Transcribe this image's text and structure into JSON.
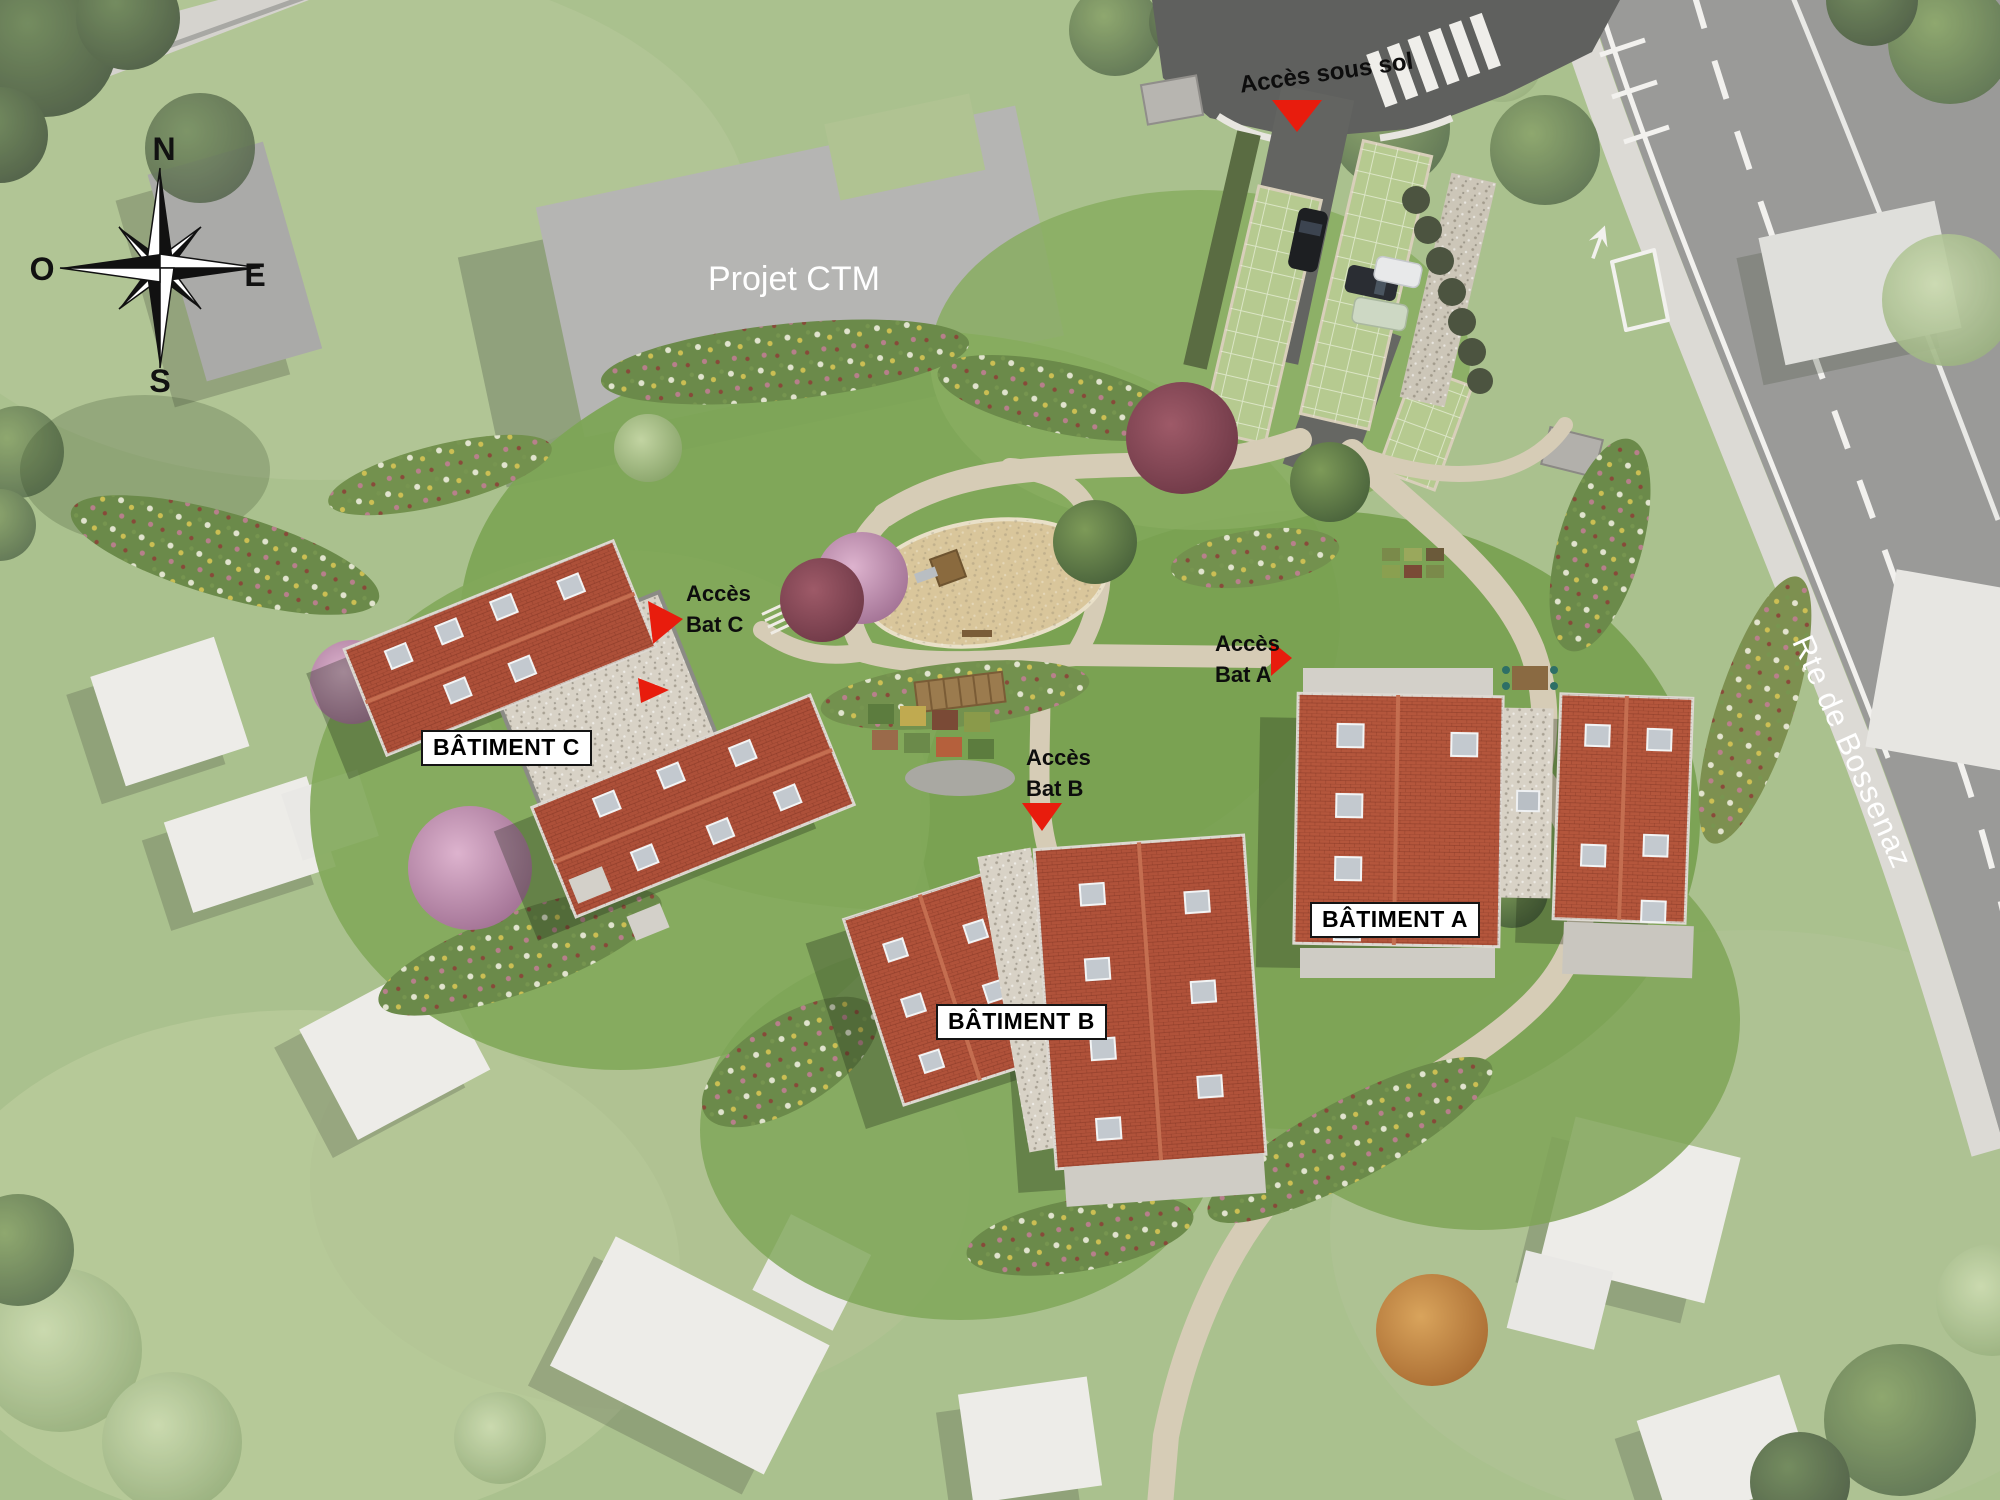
{
  "compass": {
    "n": "N",
    "o": "O",
    "e": "E",
    "s": "S"
  },
  "context": {
    "projet_ctm": "Projet CTM",
    "road_name": "Rte de Bossenaz"
  },
  "buildings": {
    "a": {
      "label": "BÂTIMENT A"
    },
    "b": {
      "label": "BÂTIMENT B"
    },
    "c": {
      "label": "BÂTIMENT C"
    }
  },
  "access": {
    "sous_sol": {
      "label": "Accès sous sol"
    },
    "bat_a": {
      "line1": "Accès",
      "line2": "Bat A"
    },
    "bat_b": {
      "line1": "Accès",
      "line2": "Bat B"
    },
    "bat_c": {
      "line1": "Accès",
      "line2": "Bat C"
    }
  },
  "colors": {
    "marker_red": "#e81c0d",
    "roof_red": "#b0523a",
    "grass_site": "#7da556",
    "grass_context": "#9db77c",
    "road_asphalt": "#8a8a88",
    "entry_asphalt": "#5f605e",
    "building_context_gray": "#a9a9a7",
    "house_white": "#eae9e5",
    "path_beige": "#d6ccb6",
    "label_bg": "#ffffff",
    "label_text": "#111111"
  }
}
